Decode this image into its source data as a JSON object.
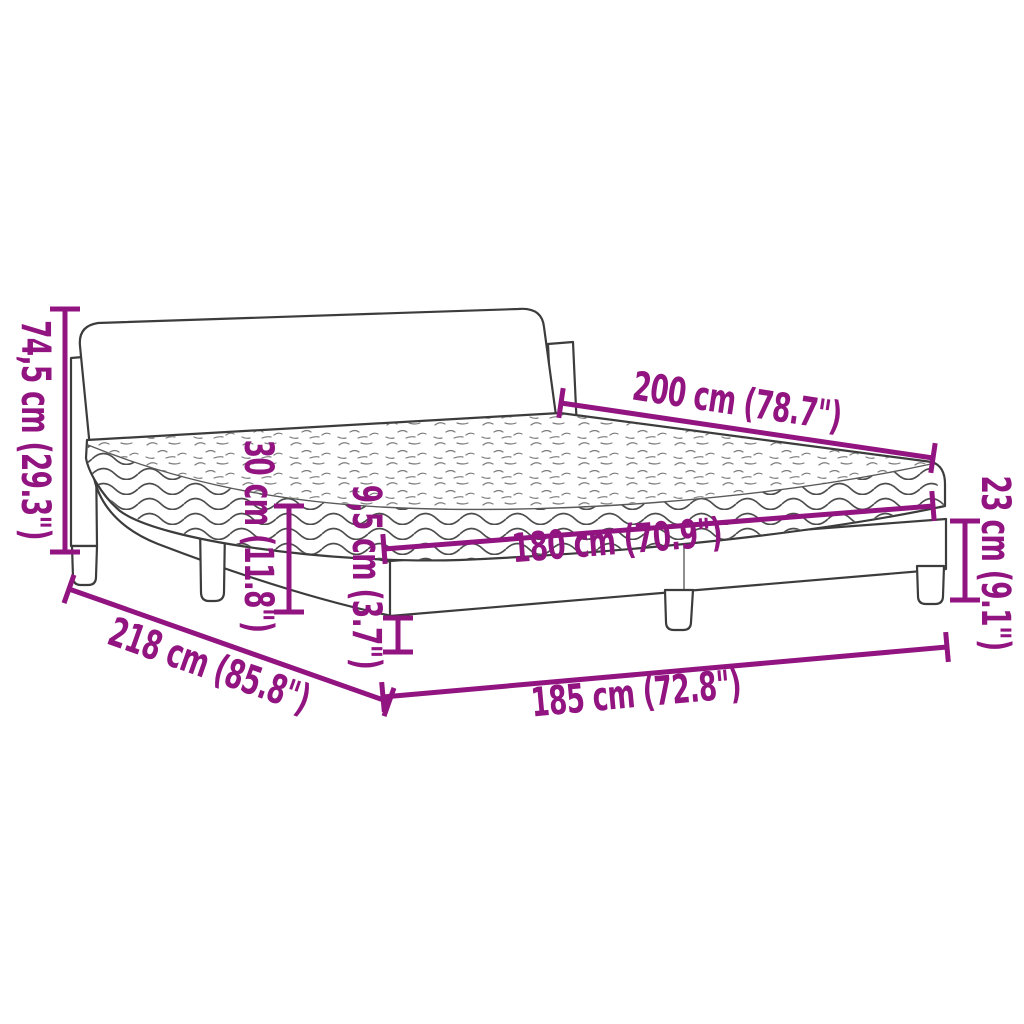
{
  "page": {
    "background": "#ffffff"
  },
  "diagram": {
    "subject": "bed-frame-with-mattress-dimension-diagram",
    "accent_color": "#911480",
    "line_color": "#3c3c3c",
    "dimensions": {
      "total_height": "74,5 cm (29.3\")",
      "length": "200 cm (78.7\")",
      "mattress_thickness": "30 cm (11.8\")",
      "base_rail_height": "9,5 cm (3.7\")",
      "mattress_width": "180 cm (70.9\")",
      "frame_height": "23 cm (9.1\")",
      "frame_diagonal_depth": "218 cm (85.8\")",
      "frame_width": "185 cm (72.8\")"
    }
  }
}
